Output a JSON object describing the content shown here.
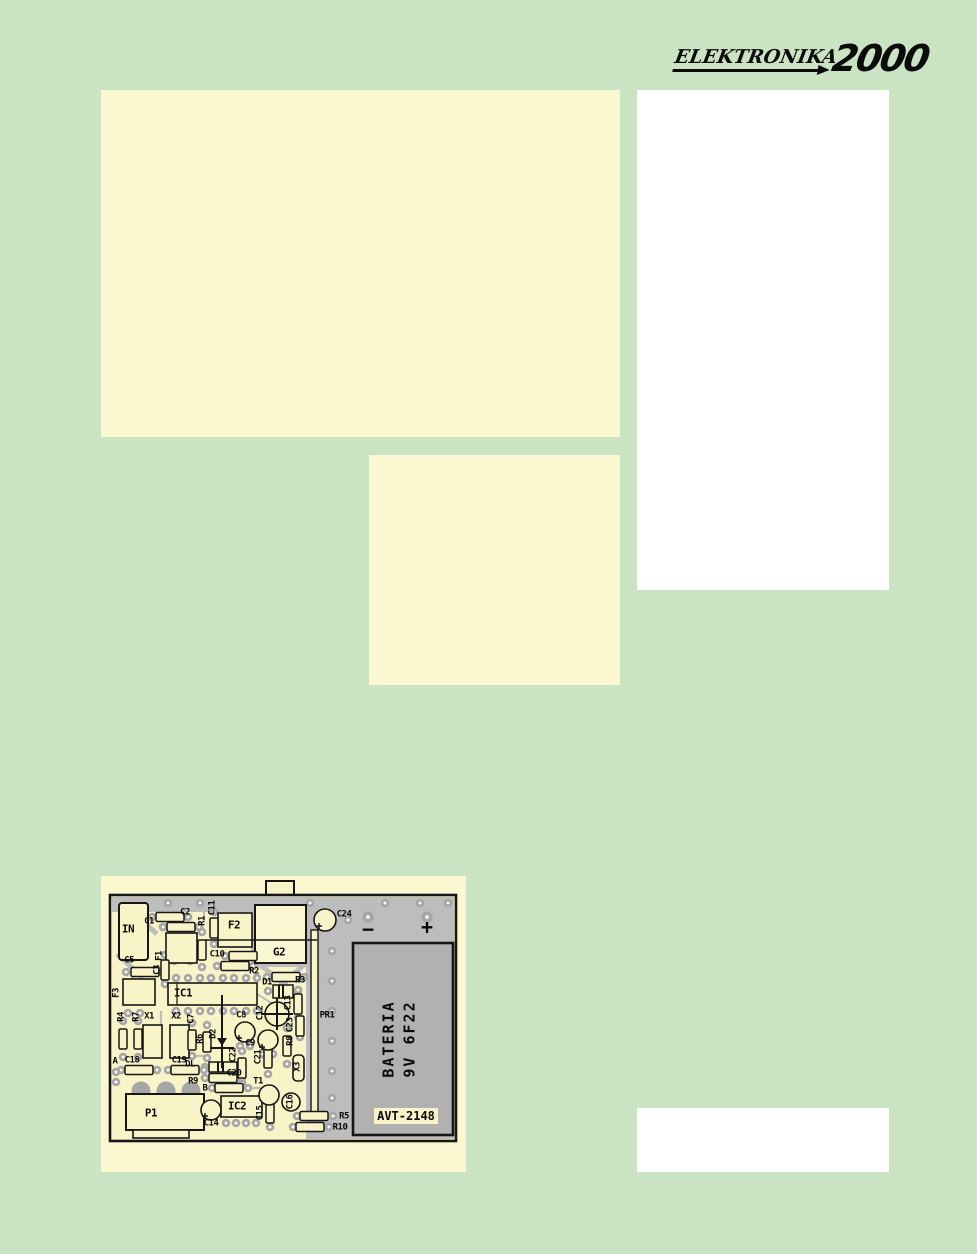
{
  "colors": {
    "background": "#c9e3c3",
    "panel_cream": "#fbf7d1",
    "panel_white": "#ffffff",
    "board_cream": "#f8f4c8",
    "copper_gray": "#bdbdbd",
    "pad_gray": "#a6a6a6",
    "battery_gray": "#b1b1b1",
    "ink": "#161616"
  },
  "logo": {
    "title": "ELEKTRONIKA",
    "year": "2000"
  },
  "pcb": {
    "labels": {
      "in": "IN",
      "c1": "C1",
      "c2": "C2",
      "c3": "C3",
      "c5": "C5",
      "c7": "C7",
      "c8": "C8",
      "c9": "C9",
      "c10": "C10",
      "c11": "C11",
      "c12": "C12",
      "c13": "C13",
      "c14": "C14",
      "c15": "C15",
      "c16": "C16",
      "c18": "C18",
      "c19": "C19",
      "c20": "C20",
      "c21": "C21",
      "c22": "C22",
      "c23": "C23",
      "c24": "C24",
      "r1": "R1",
      "r2": "R2",
      "r3": "R3",
      "r4": "R4",
      "r5": "R5",
      "r6": "R6",
      "r7": "R7",
      "r8": "R8",
      "r9": "R9",
      "r10": "R10",
      "d1": "D1",
      "d2": "D2",
      "dl": "DL",
      "f1": "F1",
      "f2": "F2",
      "f3": "F3",
      "x1": "X1",
      "x2": "X2",
      "x3": "X3",
      "g2": "G2",
      "ic1": "IC1",
      "ic2": "IC2",
      "t1": "T1",
      "p1": "P1",
      "pr1": "PR1",
      "a": "A",
      "b": "B"
    },
    "battery_line1": "BATERIA",
    "battery_line2": "9V 6F22",
    "kit_label": "AVT-2148",
    "minus_sign": "−",
    "plus_sign": "+"
  }
}
